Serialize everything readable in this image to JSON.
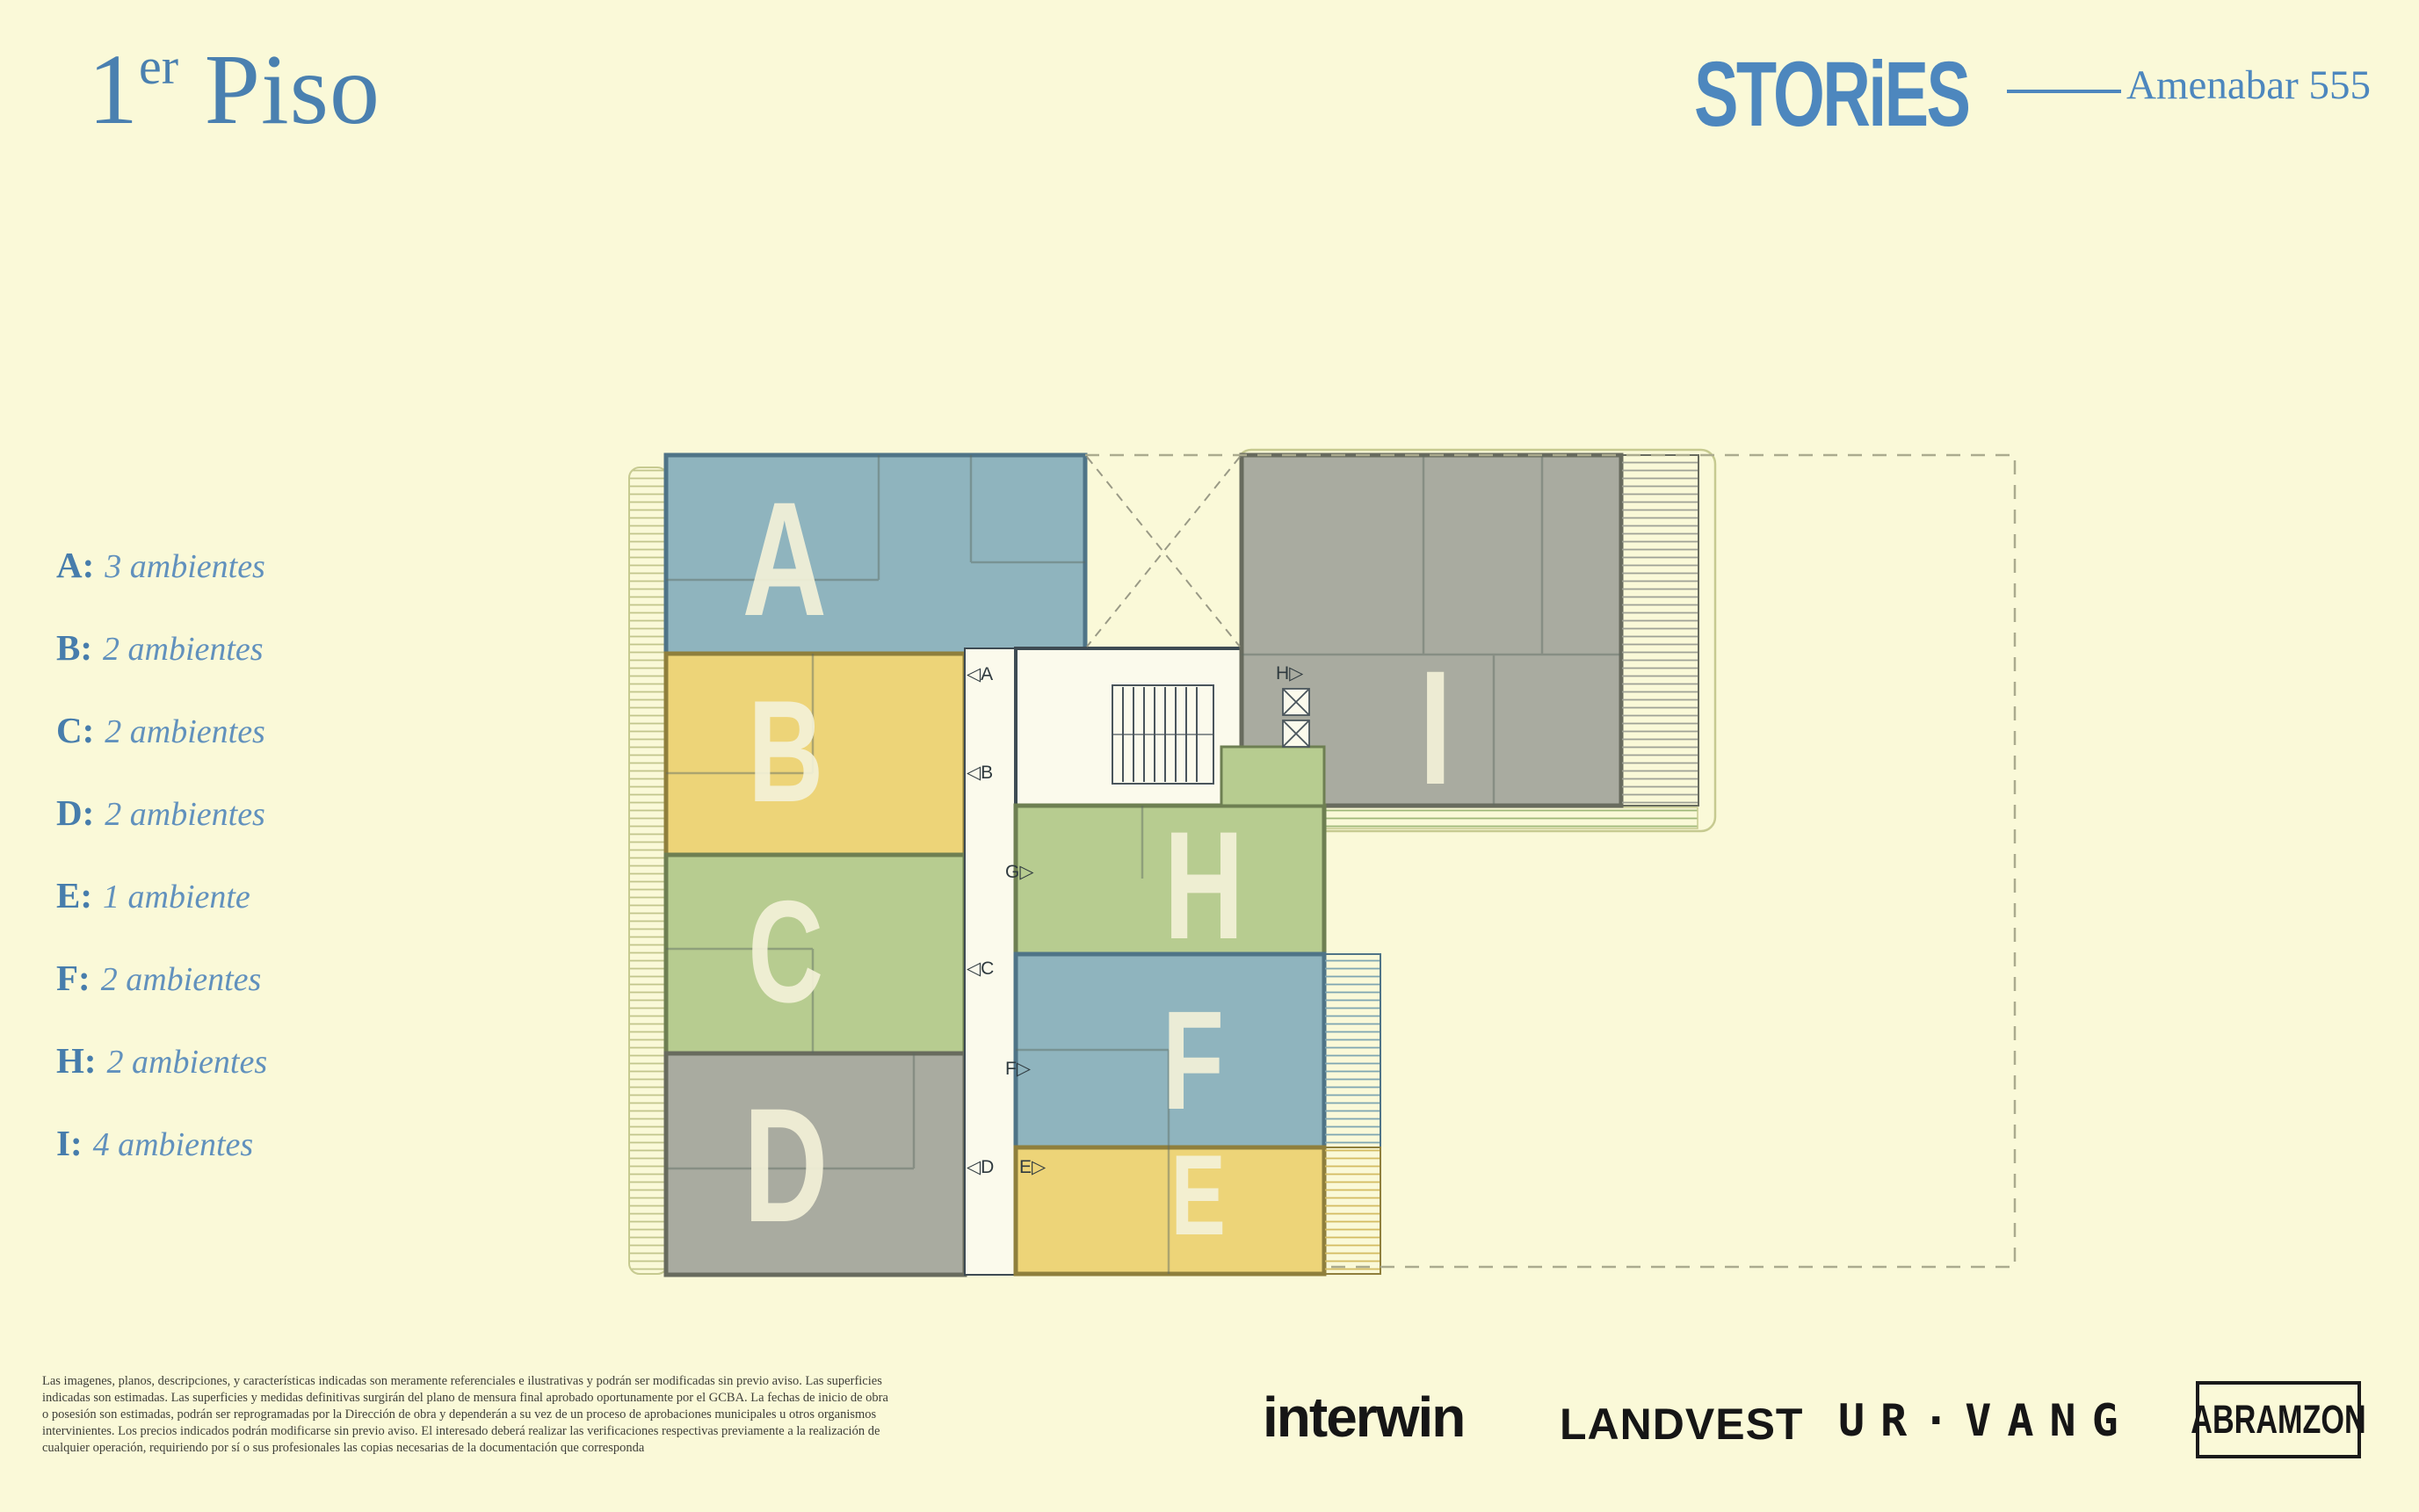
{
  "page": {
    "background": "#FAF9D8",
    "accent_blue": "#4A80B0",
    "logo_blue": "#4D87BE"
  },
  "header": {
    "floor_number": "1",
    "floor_sup": "er",
    "floor_word": "Piso",
    "brand": "STORiES",
    "address": "Amenabar 555"
  },
  "legend": {
    "items": [
      {
        "key": "A:",
        "value": "3 ambientes"
      },
      {
        "key": "B:",
        "value": "2 ambientes"
      },
      {
        "key": "C:",
        "value": "2 ambientes"
      },
      {
        "key": "D:",
        "value": "2 ambientes"
      },
      {
        "key": "E:",
        "value": "1 ambiente"
      },
      {
        "key": "F:",
        "value": "2 ambientes"
      },
      {
        "key": "H:",
        "value": "2 ambientes"
      },
      {
        "key": "I:",
        "value": "4 ambientes"
      }
    ]
  },
  "plan": {
    "units": [
      {
        "letter": "A",
        "color_name": "blue",
        "fill": "#8FB4BE",
        "wall": "#4F7487"
      },
      {
        "letter": "B",
        "color_name": "yellow",
        "fill": "#EDD478",
        "wall": "#8F7F3C"
      },
      {
        "letter": "C",
        "color_name": "green",
        "fill": "#B7CC90",
        "wall": "#6E7F52"
      },
      {
        "letter": "D",
        "color_name": "gray",
        "fill": "#A9ABA0",
        "wall": "#686B5E"
      },
      {
        "letter": "E",
        "color_name": "yellow",
        "fill": "#EDD478",
        "wall": "#8F7F3C"
      },
      {
        "letter": "F",
        "color_name": "blue",
        "fill": "#8FB4BE",
        "wall": "#4F7487"
      },
      {
        "letter": "H",
        "color_name": "green",
        "fill": "#B7CC90",
        "wall": "#6E7F52"
      },
      {
        "letter": "I",
        "color_name": "gray",
        "fill": "#A9ABA0",
        "wall": "#686B5E"
      }
    ],
    "entry_labels": [
      {
        "text": "◁A"
      },
      {
        "text": "◁B"
      },
      {
        "text": "G▷"
      },
      {
        "text": "◁C"
      },
      {
        "text": "F▷"
      },
      {
        "text": "◁D"
      },
      {
        "text": "E▷"
      },
      {
        "text": "H▷"
      }
    ],
    "letter_color": "#F4F1D8",
    "core_fill": "#FBFAEC",
    "core_wall": "#3E4B53"
  },
  "footer": {
    "disclaimer_lines": [
      "Las imagenes, planos, descripciones, y características indicadas son meramente referenciales e ilustrativas y podrán ser modificadas sin previo aviso. Las superficies",
      "indicadas son estimadas. Las superficies y medidas definitivas surgirán del plano de mensura final aprobado oportunamente por el GCBA. La fechas de inicio de obra",
      "o posesión son estimadas, podrán ser reprogramadas por la Dirección de obra y dependerán a su vez de un proceso de aprobaciones municipales u otros organismos",
      "intervinientes. Los precios indicados podrán modificarse sin previo aviso. El interesado deberá realizar las verificaciones respectivas previamente a la realización de",
      "cualquier operación, requiriendo por sí o sus profesionales las copias necesarias de la documentación que corresponda"
    ],
    "logos": [
      {
        "name": "interwin"
      },
      {
        "name": "LANDVEST"
      },
      {
        "name": "UR·VANG"
      },
      {
        "name": "ABRAMZON"
      }
    ]
  }
}
